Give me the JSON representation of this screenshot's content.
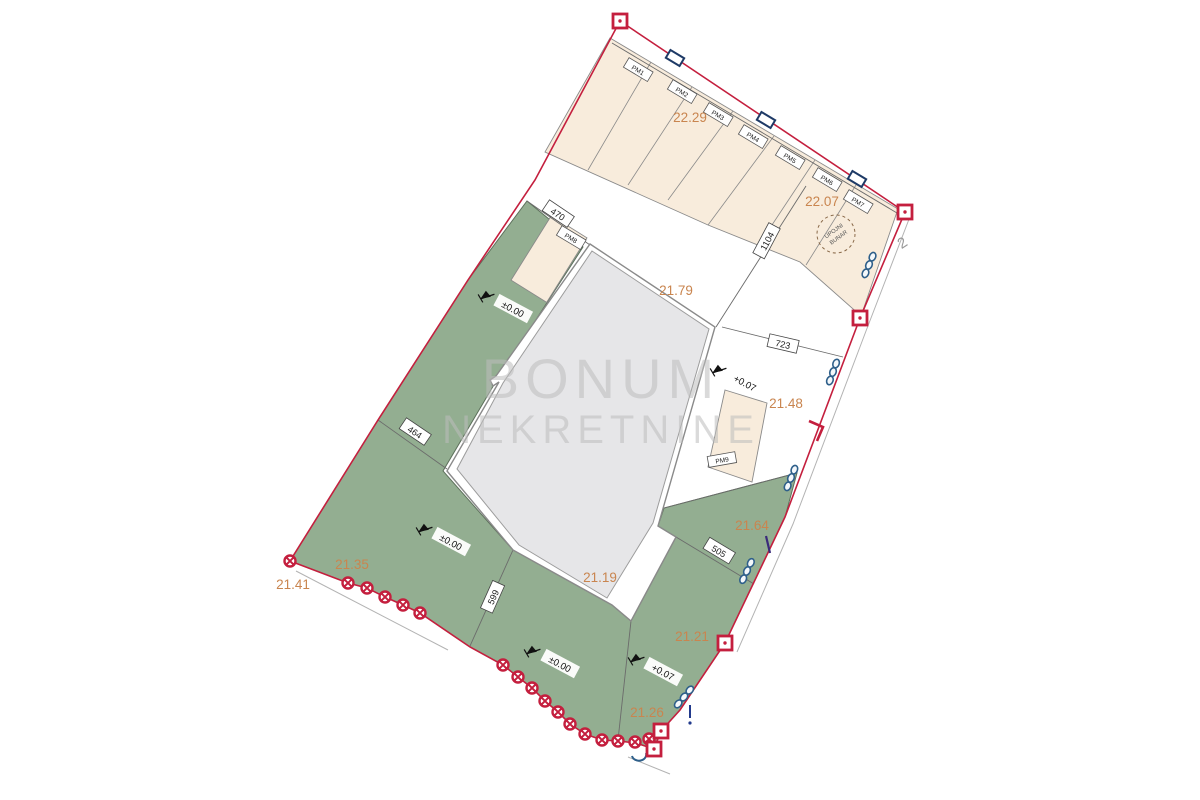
{
  "watermark": {
    "line1": "BONUM",
    "line2": "NEKRETNINE"
  },
  "well": {
    "line1": "UPOJNI",
    "line2": "BUNAR"
  },
  "edge_label": "2",
  "parking": [
    "PM1",
    "PM2",
    "PM3",
    "PM4",
    "PM5",
    "PM6",
    "PM7",
    "PM8",
    "PM9"
  ],
  "areas": {
    "a2229": "22.29",
    "a2207": "22.07",
    "a2179": "21.79",
    "a2148": "21.48",
    "a2164": "21.64",
    "a2135": "21.35",
    "a2141": "21.41",
    "a2119": "21.19",
    "a2121": "21.21",
    "a2126": "21.26"
  },
  "dims": {
    "d470": "470",
    "d1104": "1104",
    "d723": "723",
    "d464": "464",
    "d599": "599",
    "d505": "505"
  },
  "elevations": {
    "e1": "±0.00",
    "e2": "+0.07",
    "e3": "±0.00",
    "e4": "±0.00",
    "e5": "+0.07"
  },
  "colors": {
    "boundary_red": "#c41f3e",
    "green_area": "#93ae91",
    "green_edge": "#5d705b",
    "parking_beige": "#f8ecdc",
    "building_gray": "#e6e6e8",
    "outline_gray": "#8a8a8a",
    "label_orange": "#c9854f",
    "hedge_blue": "#2e5f8a",
    "watermark_gray": "#bdbdbd"
  }
}
